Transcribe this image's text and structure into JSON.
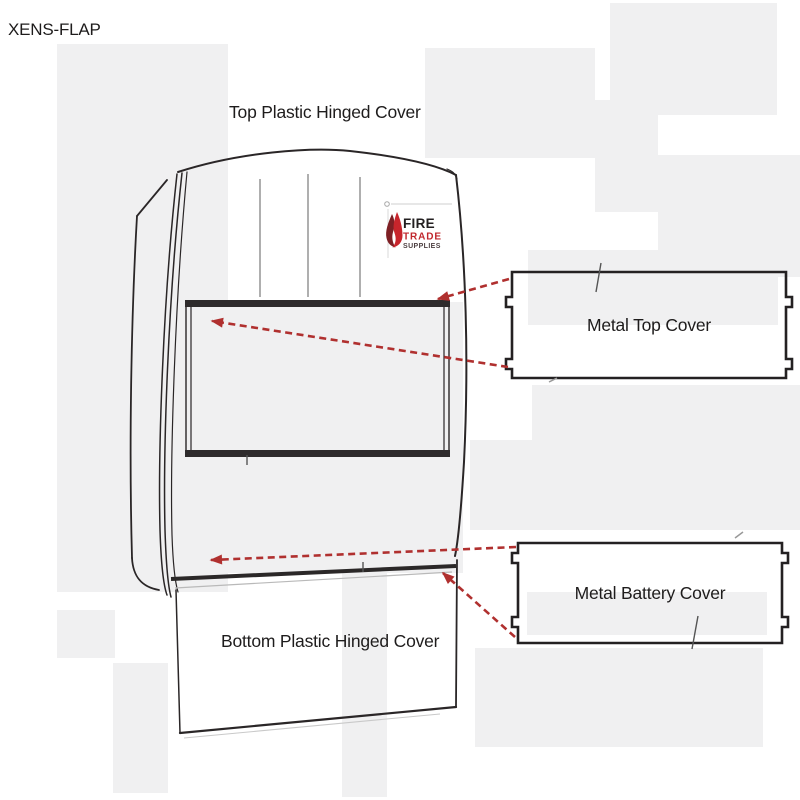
{
  "page": {
    "product_code": "XENS-FLAP"
  },
  "callouts": {
    "top_plastic": "Top Plastic Hinged Cover",
    "metal_top": "Metal Top Cover",
    "metal_battery": "Metal Battery Cover",
    "bottom_plastic": "Bottom Plastic Hinged Cover"
  },
  "logo": {
    "word1": "FIRE",
    "word2": "TRADE",
    "word3": "SUPPLIES"
  },
  "colors": {
    "callout_arrow_red": "#b0302f",
    "logo_flame_red": "#c8252c",
    "logo_trade_red": "#c0272d",
    "line_art_dark": "#2a2627",
    "watermark_gray": "#f0f0f1"
  }
}
